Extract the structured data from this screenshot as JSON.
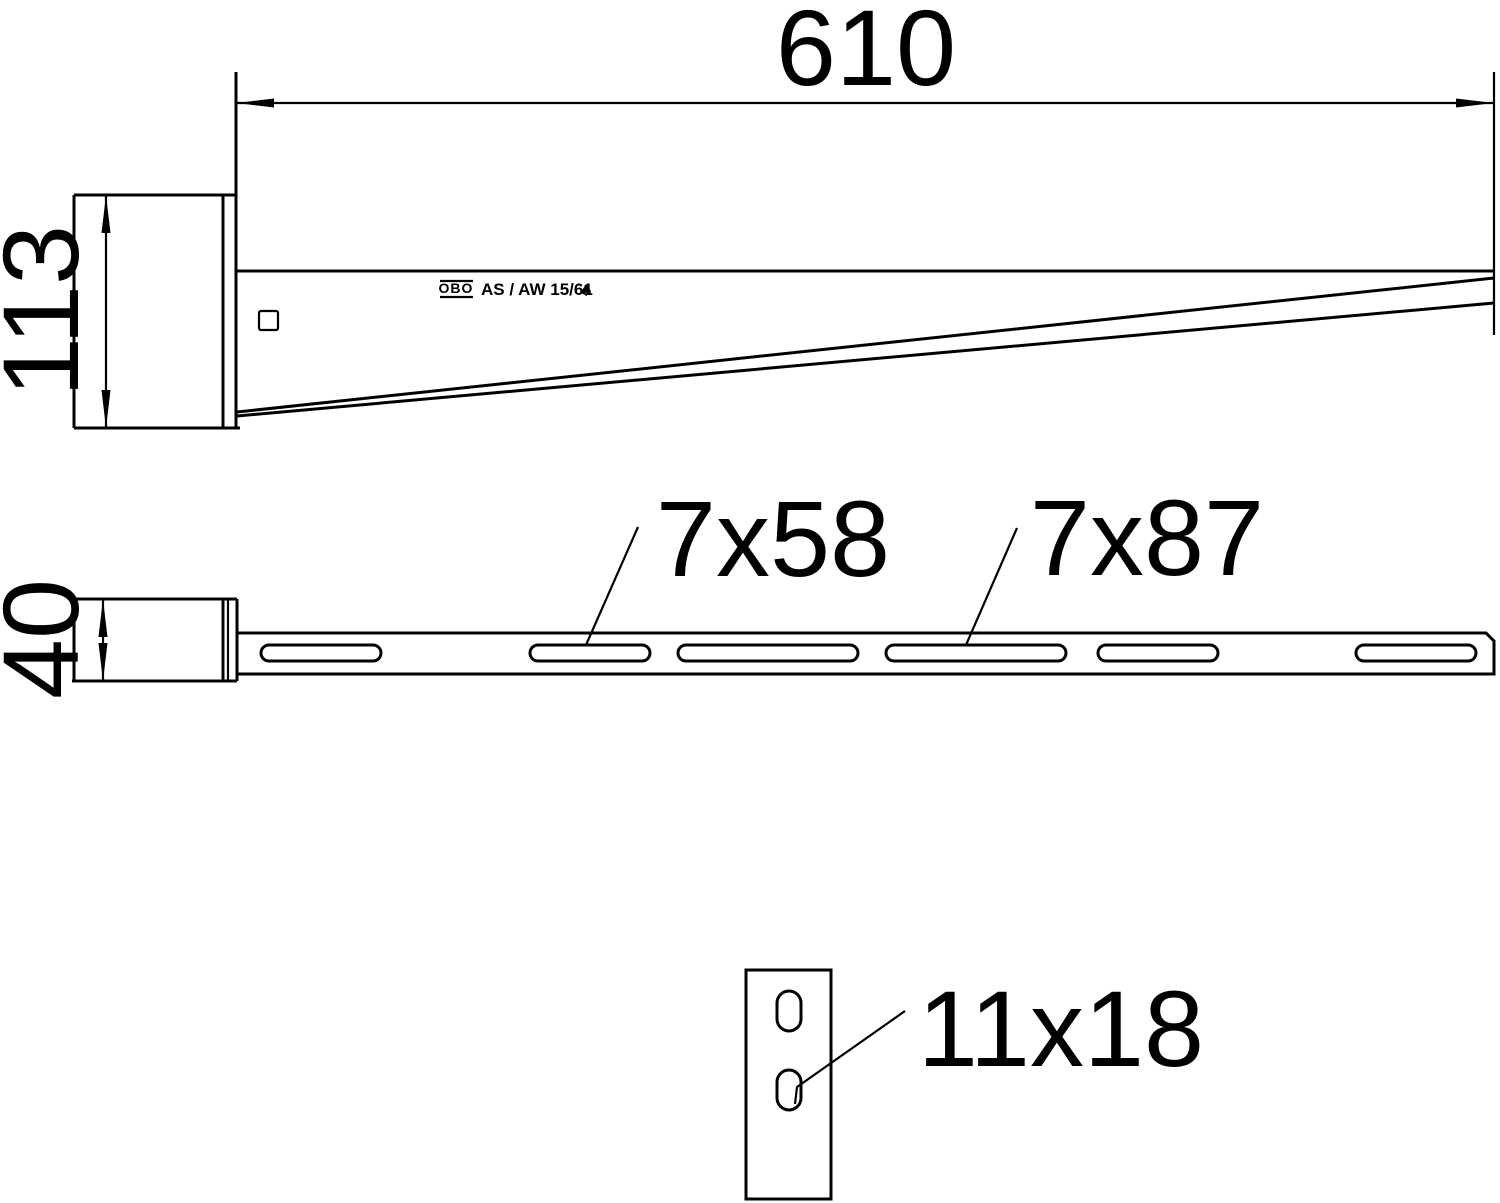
{
  "app": {
    "type": "technical-dimension-drawing",
    "brand": "OBO",
    "product_label": "AS / AW 15/61"
  },
  "symbols": {
    "certification_mark": "♠"
  },
  "dimensions": {
    "length": "610",
    "height": "113",
    "width": "40",
    "slot_small": "7x58",
    "slot_large": "7x87",
    "end_plate_hole": "11x18"
  },
  "colors": {
    "line": "#000000",
    "background": "#ffffff"
  }
}
